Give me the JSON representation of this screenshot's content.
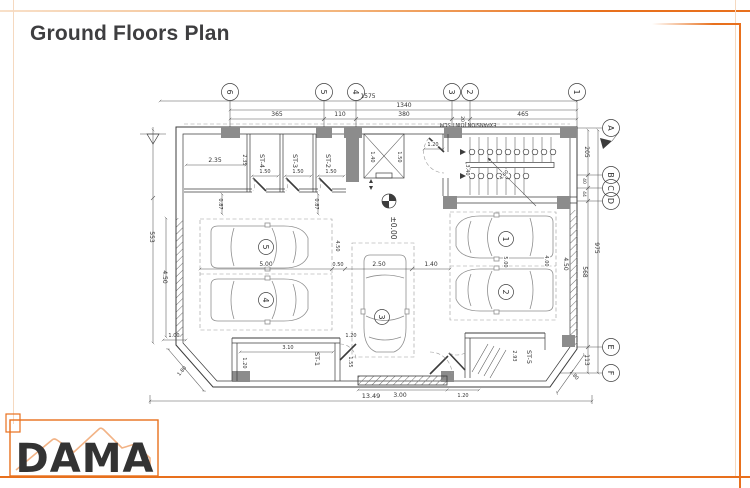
{
  "page": {
    "title": "Ground Floors Plan"
  },
  "theme": {
    "accent": "#E8701D",
    "accent_light": "#F5D9C0"
  },
  "logo": {
    "text": "DAMA"
  },
  "plan": {
    "grid_top": [
      "6",
      "5",
      "4",
      "3",
      "2",
      "1"
    ],
    "grid_right": [
      "A",
      "B",
      "C",
      "D",
      "E",
      "F"
    ],
    "parking": [
      "1",
      "2",
      "3",
      "4",
      "5"
    ],
    "rooms": {
      "st1": "ST-1",
      "st2": "ST-2",
      "st3": "ST-3",
      "st4": "ST-4",
      "st5": "ST-5"
    },
    "level_marker": "±0.00",
    "expansion_joint": "EXPANSION JOINT 5CM",
    "dims": {
      "d1575": "1575",
      "d1340": "1340",
      "d365": "365",
      "d110": "110",
      "d380": "380",
      "d465": "465",
      "d20": "20",
      "d205": "205",
      "d40": "40",
      "d44": "44",
      "d975": "975",
      "d568": "568",
      "d113": "113",
      "d553": "553",
      "d235": "2.35",
      "d450": "4.50",
      "d150": "1.50",
      "d087": "0.87",
      "d140": "1.40",
      "d340": "3.40",
      "d460": "4.60",
      "d120": "1.20",
      "d500": "5.00",
      "d050": "0.50",
      "d250": "2.50",
      "d400": "4.00",
      "d310": "3.10",
      "d100": "1.00",
      "d155": "1.55",
      "d300": "3.00",
      "d293": "2.93",
      "d1349": "13.49",
      "d180": "1.80"
    }
  }
}
